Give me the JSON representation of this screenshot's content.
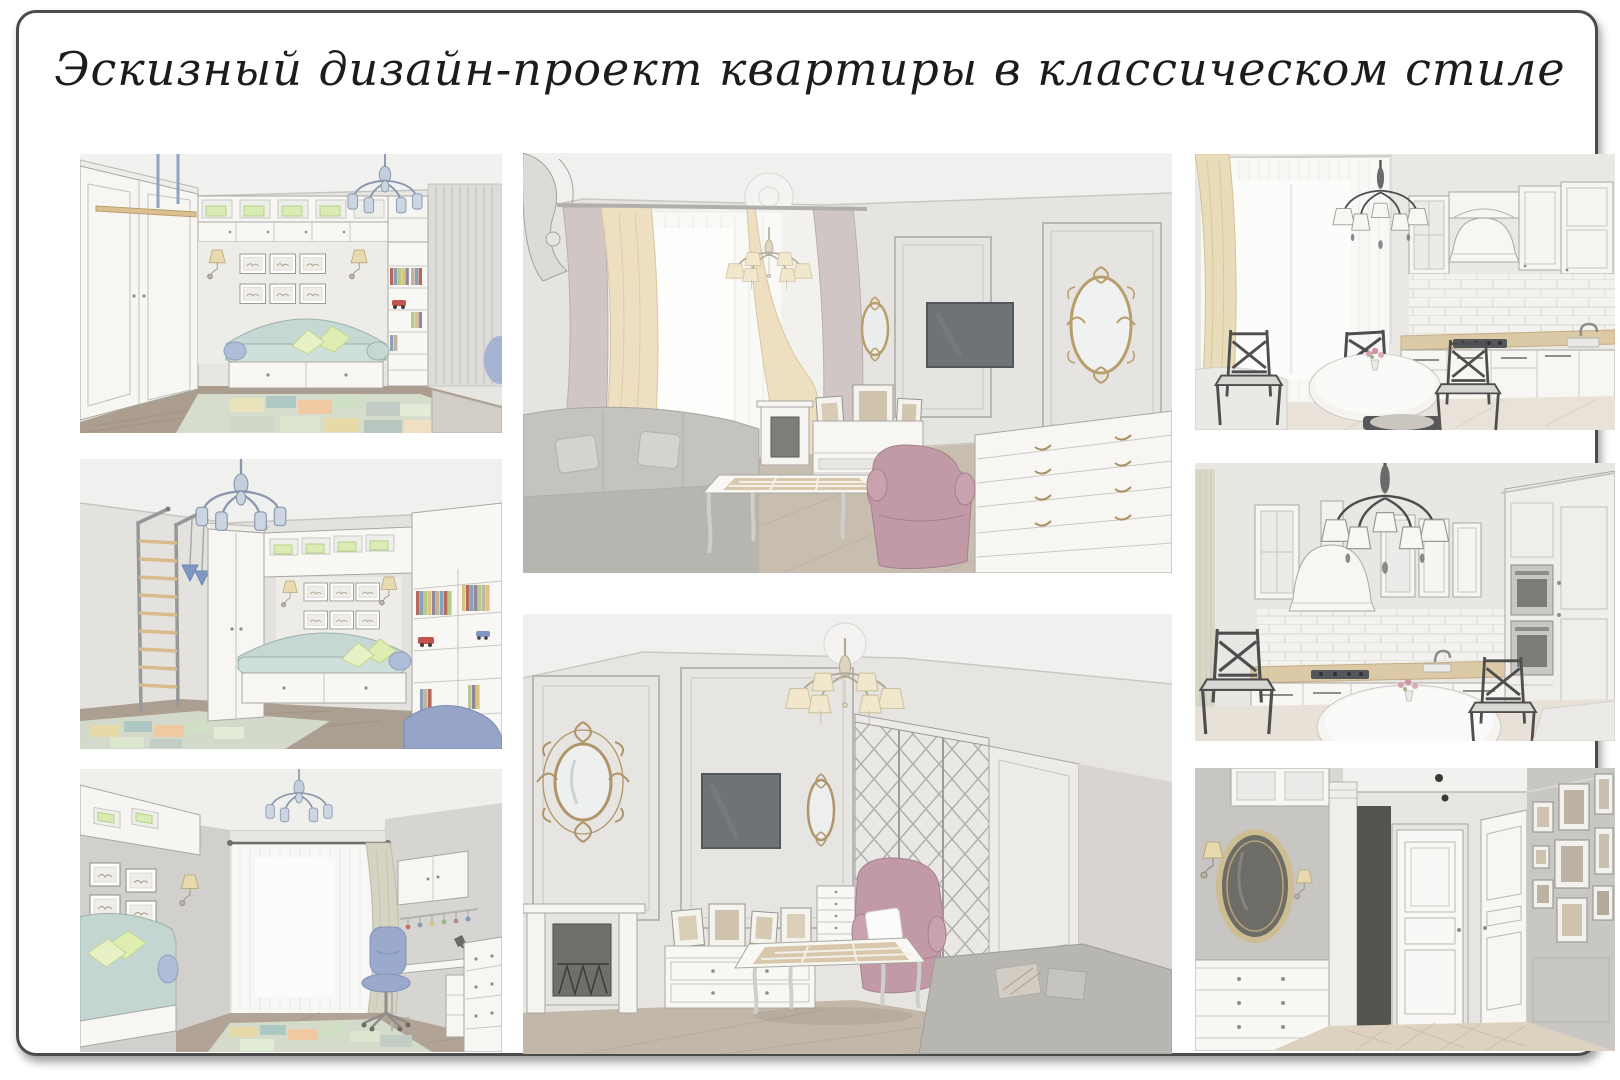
{
  "page": {
    "title": "Эскизный дизайн-проект квартиры в классическом стиле"
  },
  "board": {
    "background": "#ffffff",
    "frame_color": "#4b4b4b"
  },
  "panels": [
    {
      "name": "kids-room-daybed-wall"
    },
    {
      "name": "kids-room-ladder-view"
    },
    {
      "name": "kids-room-window-desk-view"
    },
    {
      "name": "living-room-window-view"
    },
    {
      "name": "living-room-fireplace-view"
    },
    {
      "name": "kitchen-dining-window-view"
    },
    {
      "name": "kitchen-corner-view"
    },
    {
      "name": "hallway-view"
    }
  ],
  "palette": {
    "wall": "#e4e2de",
    "mint_sofa": "#c6d8d3",
    "pillow_green": "#dfecb2",
    "mauve_armchair": "#c29aa7",
    "cream_curtain": "#ecdfc0",
    "gold_frame": "#b0946a",
    "blue_accent": "#9aa9cc",
    "wood_floor": "#b3a698",
    "dark_chair": "#4e4e4e"
  }
}
